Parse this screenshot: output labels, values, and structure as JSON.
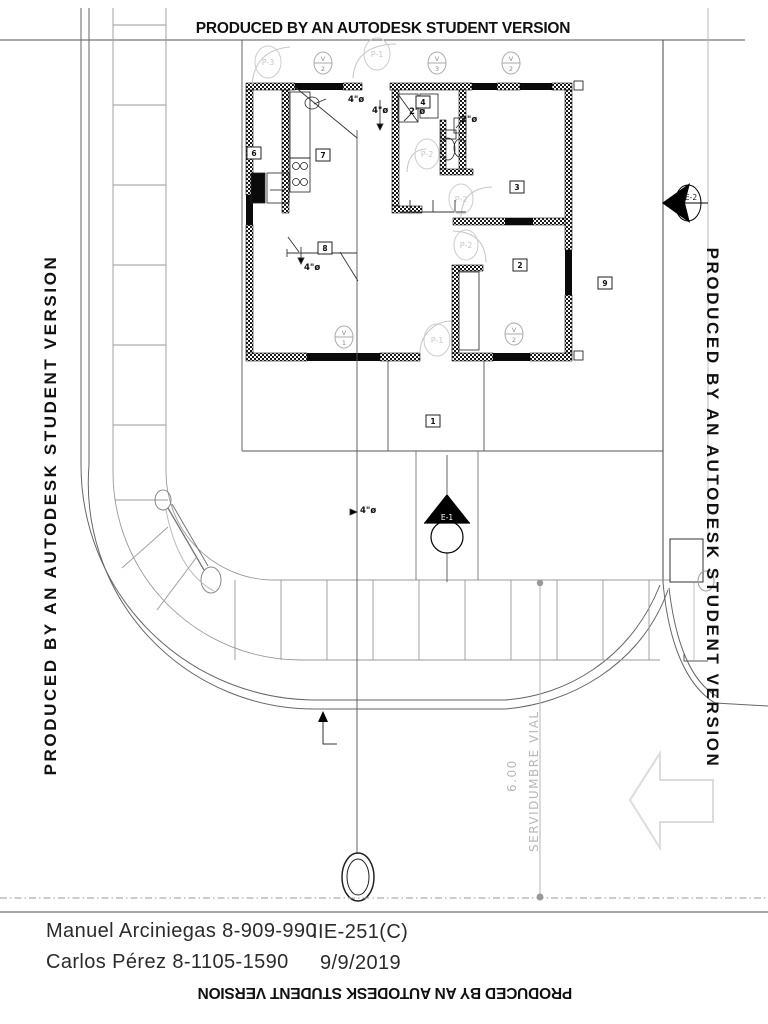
{
  "watermark": {
    "text": "PRODUCED BY AN AUTODESK STUDENT VERSION"
  },
  "titleblock": {
    "author1": "Manuel Arciniegas 8-909-990",
    "author2": "Carlos Pérez 8-1105-1590",
    "course": "IIE-251(C)",
    "date": "9/9/2019"
  },
  "site": {
    "easement_dim": "6.00",
    "easement_label": "SERVIDUMBRE VIAL"
  },
  "plan": {
    "rooms": [
      {
        "n": "1"
      },
      {
        "n": "2"
      },
      {
        "n": "3"
      },
      {
        "n": "4"
      },
      {
        "n": "6"
      },
      {
        "n": "7"
      },
      {
        "n": "8"
      },
      {
        "n": "9"
      }
    ],
    "vents": [
      {
        "t": "V",
        "n": "2"
      },
      {
        "t": "V",
        "n": "3"
      },
      {
        "t": "V",
        "n": "2"
      },
      {
        "t": "V",
        "n": "1"
      },
      {
        "t": "V",
        "n": "2"
      }
    ],
    "doors": [
      {
        "t": "P-3"
      },
      {
        "t": "P-1"
      },
      {
        "t": "P-2"
      },
      {
        "t": "P-2"
      },
      {
        "t": "P-2"
      },
      {
        "t": "P-1"
      }
    ],
    "pipes": [
      {
        "t": "4\"ø"
      },
      {
        "t": "4\"ø"
      },
      {
        "t": "2\"ø"
      },
      {
        "t": "2\"ø"
      },
      {
        "t": "4\"ø"
      },
      {
        "t": "4\"ø"
      }
    ],
    "sections": [
      {
        "t": "E-2"
      },
      {
        "t": "E-1"
      }
    ]
  },
  "colors": {
    "wall": "#111111",
    "line": "#555555",
    "site": "#999999",
    "light": "#cccccc"
  }
}
